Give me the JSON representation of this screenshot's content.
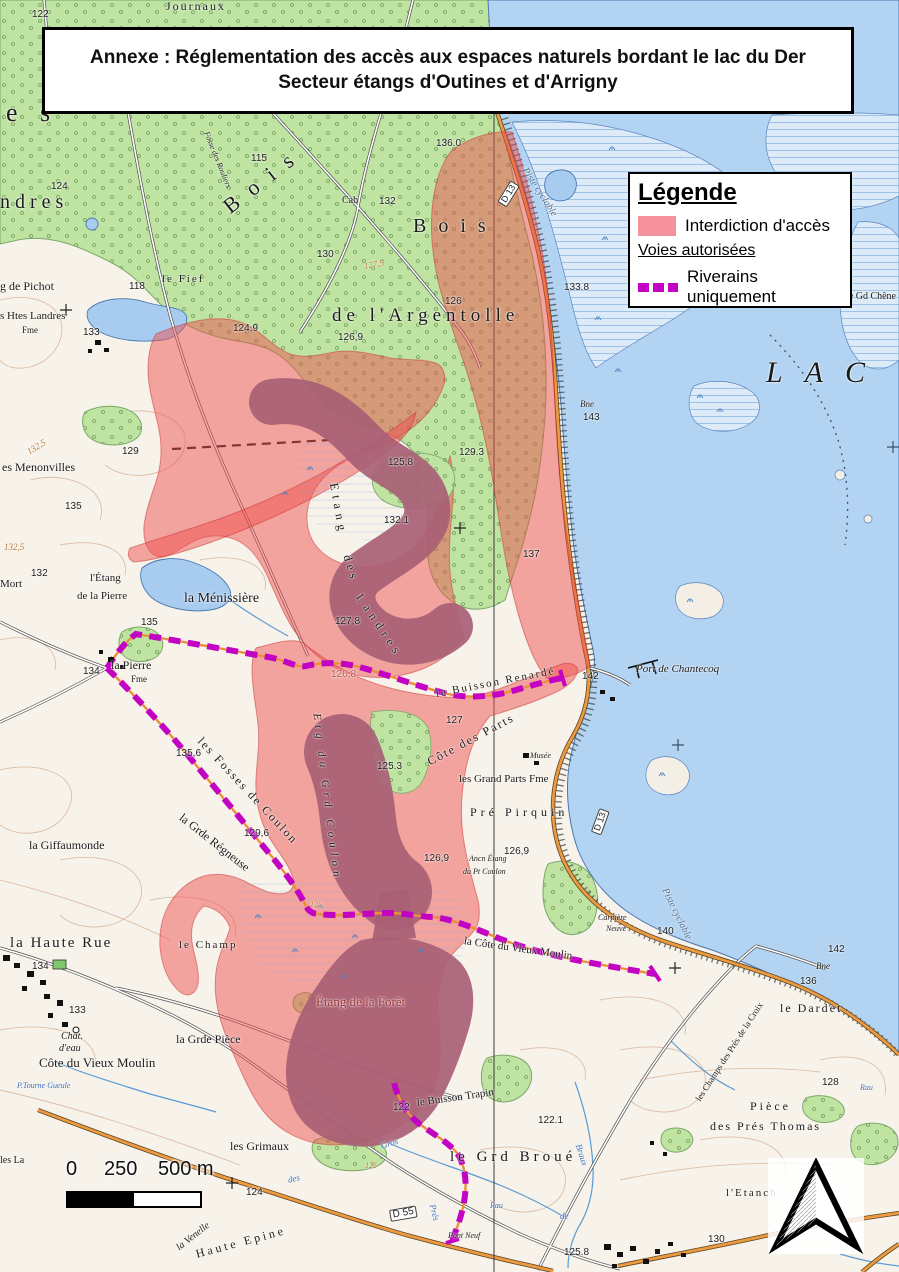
{
  "title": {
    "line1": "Annexe : Réglementation des accès aux espaces naturels bordant le lac du Der",
    "line2": "Secteur étangs d'Outines et d'Arrigny"
  },
  "legend": {
    "heading": "Légende",
    "subheading": "Voies autorisées",
    "items": [
      {
        "label": "Interdiction d'accès",
        "type": "area",
        "color": "#f6929e"
      },
      {
        "label": "Riverains uniquement",
        "type": "dashed-route",
        "color": "#c303c3"
      }
    ]
  },
  "scale_bar": {
    "labels": [
      "0",
      "250",
      "500 m"
    ]
  },
  "colors": {
    "restricted_fill": "#ee4b4b",
    "residents_route": "#c303c3",
    "lake_water": "#b2d3f2",
    "forest_green": "#bfe3a1",
    "road_orange": "#ec9a40",
    "pond_mauve": "#a85f75"
  },
  "map": {
    "labels": [
      {
        "t": "Journaux",
        "x": 166,
        "y": 0,
        "s": 12,
        "ls": 2
      },
      {
        "t": "122",
        "x": 32,
        "y": 10,
        "f": "sans"
      },
      {
        "t": "e s",
        "x": 6,
        "y": 100,
        "s": 26,
        "ls": 8
      },
      {
        "t": "ndres",
        "x": 0,
        "y": 192,
        "s": 20,
        "ls": 5
      },
      {
        "t": "124",
        "x": 51,
        "y": 182,
        "f": "sans"
      },
      {
        "t": "Fosse des Rouliers",
        "x": 206,
        "y": 128,
        "s": 8,
        "i": true,
        "r": 68
      },
      {
        "t": "Bois",
        "x": 226,
        "y": 198,
        "s": 22,
        "ls": 14,
        "r": -38
      },
      {
        "t": "Bois",
        "x": 413,
        "y": 216,
        "s": 20,
        "ls": 12
      },
      {
        "t": "de l'Argentolle",
        "x": 332,
        "y": 306,
        "s": 19,
        "ls": 5
      },
      {
        "t": "Piste cyclable",
        "x": 524,
        "y": 164,
        "s": 10,
        "i": true,
        "r": 57,
        "c": "#4d6d8f"
      },
      {
        "t": "Piste cyclable",
        "x": 664,
        "y": 884,
        "s": 10,
        "i": true,
        "r": 64,
        "c": "#4d6d8f"
      },
      {
        "t": "115",
        "x": 251,
        "y": 154,
        "f": "sans"
      },
      {
        "t": "Cab",
        "x": 342,
        "y": 196,
        "s": 10
      },
      {
        "t": "132",
        "x": 379,
        "y": 197,
        "f": "sans"
      },
      {
        "t": "136.0",
        "x": 436,
        "y": 139,
        "f": "sans"
      },
      {
        "t": "130",
        "x": 317,
        "y": 250,
        "f": "sans"
      },
      {
        "t": "127,5",
        "x": 364,
        "y": 262,
        "s": 9,
        "i": true,
        "c": "#c07a35",
        "r": -10
      },
      {
        "t": "126",
        "x": 445,
        "y": 297,
        "f": "sans"
      },
      {
        "t": "133.8",
        "x": 564,
        "y": 283,
        "f": "sans"
      },
      {
        "t": "124,9",
        "x": 233,
        "y": 324,
        "f": "sans"
      },
      {
        "t": "126,9",
        "x": 338,
        "y": 333,
        "f": "sans"
      },
      {
        "t": "le Gd Chêne",
        "x": 846,
        "y": 292,
        "s": 10
      },
      {
        "t": "118",
        "x": 129,
        "y": 282,
        "f": "sans"
      },
      {
        "t": "le Fief",
        "x": 162,
        "y": 274,
        "s": 11,
        "ls": 2
      },
      {
        "t": "g de Pichot",
        "x": 0,
        "y": 280,
        "s": 12
      },
      {
        "t": "s Htes Landres",
        "x": 0,
        "y": 311,
        "s": 11
      },
      {
        "t": "Fme",
        "x": 22,
        "y": 326,
        "s": 9
      },
      {
        "t": "133",
        "x": 83,
        "y": 328,
        "f": "sans"
      },
      {
        "t": "LAC",
        "x": 766,
        "y": 358,
        "s": 30,
        "i": true,
        "ls": 22
      },
      {
        "t": "Bne",
        "x": 580,
        "y": 400,
        "s": 9,
        "i": true
      },
      {
        "t": "143",
        "x": 583,
        "y": 413,
        "f": "sans"
      },
      {
        "t": "es Menonvilles",
        "x": 2,
        "y": 461,
        "s": 12
      },
      {
        "t": "129",
        "x": 122,
        "y": 447,
        "f": "sans"
      },
      {
        "t": "132,5",
        "x": 28,
        "y": 448,
        "s": 9,
        "i": true,
        "c": "#c07a35",
        "r": -32
      },
      {
        "t": "135",
        "x": 65,
        "y": 502,
        "f": "sans"
      },
      {
        "t": "132,5",
        "x": 4,
        "y": 543,
        "s": 9,
        "i": true,
        "c": "#c07a35"
      },
      {
        "t": "132",
        "x": 31,
        "y": 569,
        "f": "sans"
      },
      {
        "t": "Mort",
        "x": 0,
        "y": 579,
        "s": 11
      },
      {
        "t": "l'Étang",
        "x": 90,
        "y": 573,
        "s": 11
      },
      {
        "t": "de la Pierre",
        "x": 77,
        "y": 591,
        "s": 11
      },
      {
        "t": "la Ménissière",
        "x": 184,
        "y": 592,
        "s": 14
      },
      {
        "t": "135",
        "x": 141,
        "y": 618,
        "f": "sans"
      },
      {
        "t": "129.3",
        "x": 459,
        "y": 448,
        "f": "sans"
      },
      {
        "t": "125,8",
        "x": 388,
        "y": 458,
        "f": "sans"
      },
      {
        "t": "132.1",
        "x": 384,
        "y": 516,
        "f": "sans"
      },
      {
        "t": "137",
        "x": 523,
        "y": 550,
        "f": "sans"
      },
      {
        "t": "Etang",
        "x": 334,
        "y": 477,
        "s": 12,
        "ls": 5,
        "r": 80
      },
      {
        "t": "des",
        "x": 347,
        "y": 549,
        "s": 12,
        "ls": 4,
        "r": 72
      },
      {
        "t": "Landres",
        "x": 359,
        "y": 589,
        "s": 12,
        "ls": 5,
        "r": 56
      },
      {
        "t": "127,8",
        "x": 335,
        "y": 617,
        "f": "sans"
      },
      {
        "t": "126,8",
        "x": 331,
        "y": 670,
        "f": "sans",
        "c": "#b05555"
      },
      {
        "t": "142",
        "x": 582,
        "y": 672,
        "f": "sans"
      },
      {
        "t": "Port de Chantecoq",
        "x": 636,
        "y": 664,
        "s": 11,
        "i": true
      },
      {
        "t": "le Buisson Renardé",
        "x": 436,
        "y": 689,
        "s": 11,
        "r": -11,
        "ls": 2
      },
      {
        "t": "127",
        "x": 446,
        "y": 716,
        "f": "sans"
      },
      {
        "t": "la Pierre",
        "x": 111,
        "y": 659,
        "s": 12
      },
      {
        "t": "Fme",
        "x": 131,
        "y": 675,
        "s": 9
      },
      {
        "t": "134",
        "x": 83,
        "y": 667,
        "f": "sans"
      },
      {
        "t": "D 13",
        "x": 502,
        "y": 199,
        "f": "sans",
        "s": 9,
        "r": -58,
        "box": true
      },
      {
        "t": "D 13",
        "x": 596,
        "y": 828,
        "f": "sans",
        "s": 9,
        "r": -70,
        "box": true
      },
      {
        "t": "Côte des Parts",
        "x": 428,
        "y": 756,
        "s": 12,
        "r": -28,
        "ls": 2
      },
      {
        "t": "Musée",
        "x": 530,
        "y": 752,
        "s": 8,
        "i": true
      },
      {
        "t": "les Grand Parts Fme",
        "x": 459,
        "y": 774,
        "s": 11
      },
      {
        "t": "Pré Pirquin",
        "x": 470,
        "y": 806,
        "s": 12,
        "ls": 4
      },
      {
        "t": "Ancn Étang",
        "x": 469,
        "y": 855,
        "s": 8,
        "i": true
      },
      {
        "t": "du Pt Coulon",
        "x": 463,
        "y": 868,
        "s": 8,
        "i": true
      },
      {
        "t": "126,9",
        "x": 504,
        "y": 847,
        "f": "sans"
      },
      {
        "t": "126,9",
        "x": 424,
        "y": 854,
        "f": "sans"
      },
      {
        "t": "les Fosses de Coulon",
        "x": 200,
        "y": 733,
        "s": 12,
        "r": 47,
        "ls": 2
      },
      {
        "t": "135,6",
        "x": 176,
        "y": 749,
        "f": "sans"
      },
      {
        "t": "129,6",
        "x": 244,
        "y": 829,
        "f": "sans"
      },
      {
        "t": "125.3",
        "x": 377,
        "y": 762,
        "f": "sans"
      },
      {
        "t": "la Grde Régneuse",
        "x": 181,
        "y": 810,
        "s": 12,
        "r": 38
      },
      {
        "t": "Etg du Grd Coulon",
        "x": 316,
        "y": 708,
        "s": 11,
        "i": true,
        "ls": 5,
        "r": 83
      },
      {
        "t": "la Giffaumonde",
        "x": 29,
        "y": 839,
        "s": 12
      },
      {
        "t": "125",
        "x": 310,
        "y": 901,
        "s": 8,
        "i": true,
        "c": "#c07a35"
      },
      {
        "t": "la Haute Rue",
        "x": 10,
        "y": 936,
        "s": 15,
        "ls": 2
      },
      {
        "t": "134",
        "x": 32,
        "y": 962,
        "f": "sans"
      },
      {
        "t": "le Champ",
        "x": 179,
        "y": 940,
        "s": 11,
        "ls": 2
      },
      {
        "t": "133",
        "x": 69,
        "y": 1006,
        "f": "sans"
      },
      {
        "t": "Chât.",
        "x": 61,
        "y": 1032,
        "s": 10,
        "i": true
      },
      {
        "t": "d'eau",
        "x": 59,
        "y": 1044,
        "s": 10,
        "i": true
      },
      {
        "t": "Côte du Vieux Moulin",
        "x": 39,
        "y": 1056,
        "s": 13
      },
      {
        "t": "P.Tourne Gueule",
        "x": 17,
        "y": 1082,
        "s": 8,
        "i": true,
        "c": "#3a6ebf"
      },
      {
        "t": "la Grde Pièce",
        "x": 176,
        "y": 1033,
        "s": 12
      },
      {
        "t": "Étang de la Forêt",
        "x": 316,
        "y": 995,
        "s": 13,
        "c": "#a03535"
      },
      {
        "t": "Carpière",
        "x": 598,
        "y": 914,
        "s": 8,
        "i": true
      },
      {
        "t": "Neuve",
        "x": 606,
        "y": 925,
        "s": 8,
        "i": true
      },
      {
        "t": "la Côte du Vieux Moulin",
        "x": 464,
        "y": 936,
        "s": 11,
        "r": 8
      },
      {
        "t": "140",
        "x": 657,
        "y": 927,
        "f": "sans"
      },
      {
        "t": "142",
        "x": 828,
        "y": 945,
        "f": "sans"
      },
      {
        "t": "Bne",
        "x": 816,
        "y": 962,
        "s": 9,
        "i": true
      },
      {
        "t": "136",
        "x": 800,
        "y": 977,
        "f": "sans"
      },
      {
        "t": "le Dardet",
        "x": 780,
        "y": 1002,
        "s": 12,
        "ls": 2
      },
      {
        "t": "les Champs des Prés de la Croix",
        "x": 698,
        "y": 1096,
        "s": 9,
        "r": -57
      },
      {
        "t": "128",
        "x": 822,
        "y": 1078,
        "f": "sans"
      },
      {
        "t": "Pièce",
        "x": 750,
        "y": 1100,
        "s": 12,
        "ls": 3
      },
      {
        "t": "des Prés Thomas",
        "x": 710,
        "y": 1120,
        "s": 12,
        "ls": 2
      },
      {
        "t": "l'Etanch",
        "x": 726,
        "y": 1188,
        "s": 11,
        "ls": 2
      },
      {
        "t": "le Buisson Trapin",
        "x": 417,
        "y": 1098,
        "s": 11,
        "r": -8
      },
      {
        "t": "122",
        "x": 393,
        "y": 1103,
        "f": "sans"
      },
      {
        "t": "le Grd Broué",
        "x": 450,
        "y": 1150,
        "s": 15,
        "ls": 4
      },
      {
        "t": "122.1",
        "x": 538,
        "y": 1116,
        "f": "sans"
      },
      {
        "t": "les Grimaux",
        "x": 230,
        "y": 1140,
        "s": 12
      },
      {
        "t": "Gros",
        "x": 381,
        "y": 1142,
        "s": 9,
        "i": true,
        "c": "#3a6ebf",
        "r": -18
      },
      {
        "t": "des",
        "x": 288,
        "y": 1176,
        "s": 9,
        "i": true,
        "c": "#3a6ebf",
        "r": -14
      },
      {
        "t": "Prés",
        "x": 432,
        "y": 1200,
        "s": 9,
        "i": true,
        "c": "#3a6ebf",
        "r": 76
      },
      {
        "t": "Braux",
        "x": 578,
        "y": 1140,
        "s": 9,
        "i": true,
        "c": "#3a6ebf",
        "r": 72
      },
      {
        "t": "de",
        "x": 560,
        "y": 1212,
        "s": 9,
        "i": true,
        "c": "#3a6ebf"
      },
      {
        "t": "Rau",
        "x": 490,
        "y": 1202,
        "s": 8,
        "i": true,
        "c": "#3a6ebf"
      },
      {
        "t": "Rau",
        "x": 860,
        "y": 1084,
        "s": 8,
        "i": true,
        "c": "#3a6ebf"
      },
      {
        "t": "124",
        "x": 246,
        "y": 1188,
        "f": "sans"
      },
      {
        "t": "D 55",
        "x": 390,
        "y": 1210,
        "f": "sans",
        "s": 10,
        "r": -10,
        "box": true
      },
      {
        "t": "Pont Neuf",
        "x": 448,
        "y": 1232,
        "s": 8,
        "i": true
      },
      {
        "t": "130",
        "x": 708,
        "y": 1235,
        "f": "sans"
      },
      {
        "t": "125.8",
        "x": 564,
        "y": 1248,
        "f": "sans"
      },
      {
        "t": "Haute Epine",
        "x": 196,
        "y": 1248,
        "s": 12,
        "r": -15,
        "ls": 3
      },
      {
        "t": "la Venelle",
        "x": 178,
        "y": 1244,
        "s": 10,
        "i": true,
        "r": -38
      },
      {
        "t": "les La",
        "x": 0,
        "y": 1156,
        "s": 10
      },
      {
        "t": "125",
        "x": 365,
        "y": 1162,
        "s": 8,
        "i": true,
        "c": "#c07a35"
      }
    ]
  }
}
